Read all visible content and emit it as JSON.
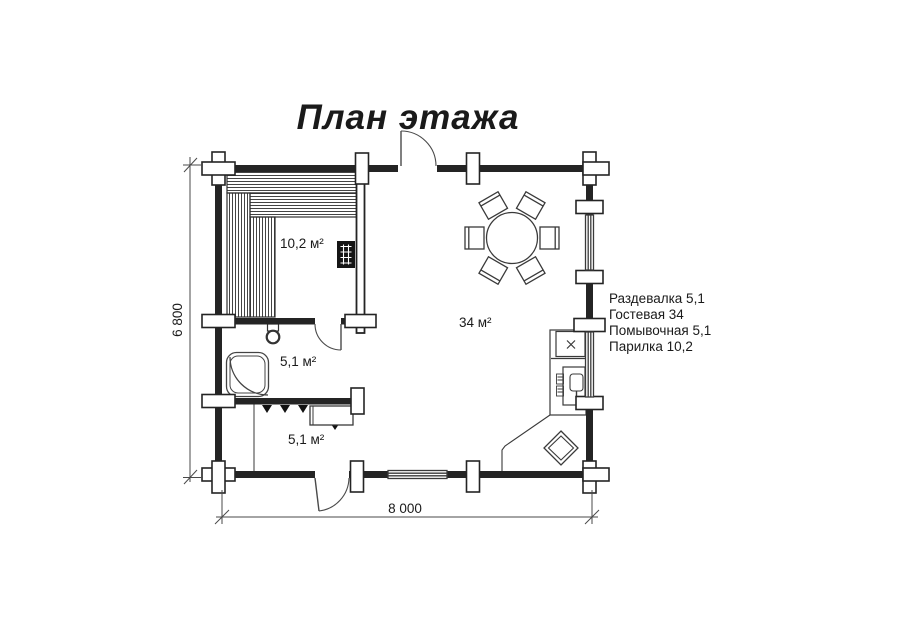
{
  "title": "План этажа",
  "rooms": {
    "sauna_area": "10,2 м²",
    "guest_area": "34 м²",
    "wash_area": "5,1 м²",
    "dressing_area": "5,1 м²"
  },
  "legend": {
    "items": [
      "Раздевалка 5,1",
      "Гостевая 34",
      "Помывочная 5,1",
      "Парилка 10,2"
    ]
  },
  "dimensions": {
    "width_label": "8 000",
    "height_label": "6 800"
  },
  "colors": {
    "wall": "#242424",
    "line": "#444444",
    "text": "#1a1a1a",
    "background": "#ffffff"
  }
}
